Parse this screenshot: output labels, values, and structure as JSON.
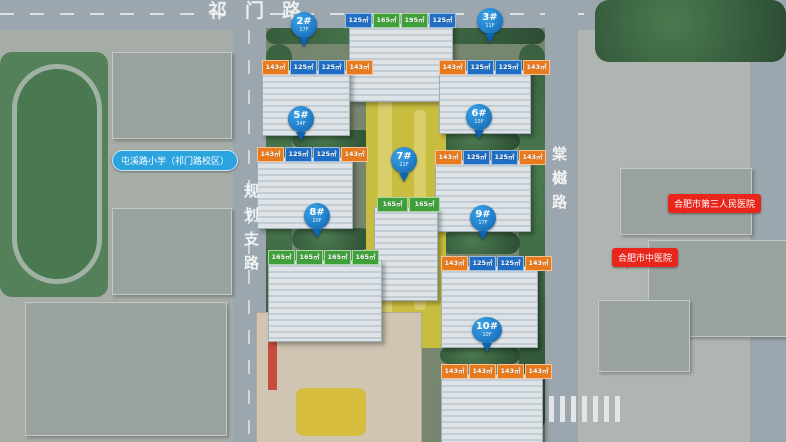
{
  "roads": {
    "top": "祁门路",
    "left": "规划支路",
    "right": "棠樾路"
  },
  "landmarks": {
    "school": "屯溪路小学（祁门路校区）",
    "hospital_top": "合肥市第三人民医院",
    "hospital_bottom": "合肥市中医院"
  },
  "colors": {
    "pin_blue": "#1372c8",
    "tag_blue": "#1f6ec4",
    "tag_orange": "#e87a1e",
    "tag_green": "#3fa03a",
    "hospital_red": "#e8261c",
    "school_pill_blue": "#2ba3df"
  },
  "buildings": [
    {
      "id": "top-tower",
      "pin_label": "",
      "pin_sub": "",
      "tags": [
        {
          "text": "125㎡",
          "color": "blue"
        },
        {
          "text": "165㎡",
          "color": "green"
        },
        {
          "text": "195㎡",
          "color": "green"
        },
        {
          "text": "125㎡",
          "color": "blue"
        }
      ]
    },
    {
      "id": "2#",
      "pin_label": "2#",
      "pin_sub": "17F",
      "tags": [
        {
          "text": "143㎡",
          "color": "orange"
        },
        {
          "text": "125㎡",
          "color": "blue"
        },
        {
          "text": "125㎡",
          "color": "blue"
        },
        {
          "text": "143㎡",
          "color": "orange"
        }
      ]
    },
    {
      "id": "3#",
      "pin_label": "3#",
      "pin_sub": "11F",
      "tags": [
        {
          "text": "143㎡",
          "color": "orange"
        },
        {
          "text": "125㎡",
          "color": "blue"
        },
        {
          "text": "125㎡",
          "color": "blue"
        },
        {
          "text": "143㎡",
          "color": "orange"
        }
      ]
    },
    {
      "id": "5#",
      "pin_label": "5#",
      "pin_sub": "34F",
      "tags": [
        {
          "text": "143㎡",
          "color": "orange"
        },
        {
          "text": "125㎡",
          "color": "blue"
        },
        {
          "text": "125㎡",
          "color": "blue"
        },
        {
          "text": "143㎡",
          "color": "orange"
        }
      ]
    },
    {
      "id": "6#",
      "pin_label": "6#",
      "pin_sub": "15F",
      "tags": [
        {
          "text": "143㎡",
          "color": "orange"
        },
        {
          "text": "125㎡",
          "color": "blue"
        },
        {
          "text": "125㎡",
          "color": "blue"
        },
        {
          "text": "143㎡",
          "color": "orange"
        }
      ]
    },
    {
      "id": "7#",
      "pin_label": "7#",
      "pin_sub": "21F",
      "tags": [
        {
          "text": "165㎡",
          "color": "green"
        },
        {
          "text": "165㎡",
          "color": "green"
        }
      ]
    },
    {
      "id": "8#",
      "pin_label": "8#",
      "pin_sub": "10F",
      "tags": [
        {
          "text": "165㎡",
          "color": "green"
        },
        {
          "text": "165㎡",
          "color": "green"
        },
        {
          "text": "165㎡",
          "color": "green"
        },
        {
          "text": "165㎡",
          "color": "green"
        }
      ]
    },
    {
      "id": "9#",
      "pin_label": "9#",
      "pin_sub": "17F",
      "tags": [
        {
          "text": "143㎡",
          "color": "orange"
        },
        {
          "text": "125㎡",
          "color": "blue"
        },
        {
          "text": "125㎡",
          "color": "blue"
        },
        {
          "text": "143㎡",
          "color": "orange"
        }
      ]
    },
    {
      "id": "10#",
      "pin_label": "10#",
      "pin_sub": "10F",
      "tags": [
        {
          "text": "143㎡",
          "color": "orange"
        },
        {
          "text": "143㎡",
          "color": "orange"
        },
        {
          "text": "143㎡",
          "color": "orange"
        },
        {
          "text": "143㎡",
          "color": "orange"
        }
      ]
    }
  ]
}
